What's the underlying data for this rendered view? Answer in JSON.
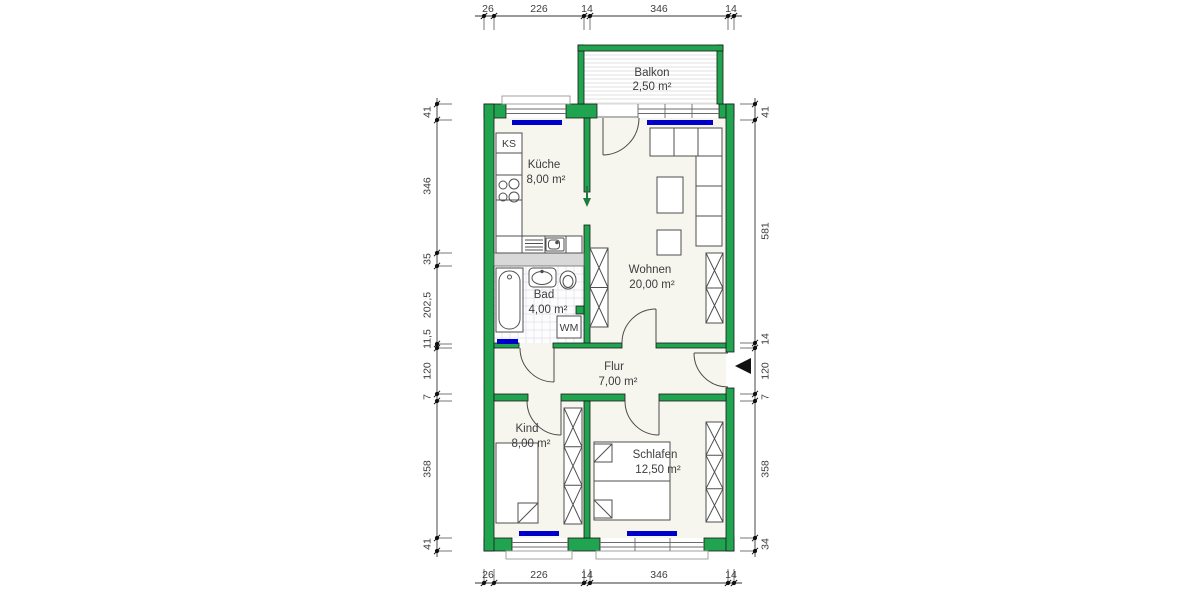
{
  "type": "floor-plan",
  "rooms": [
    {
      "name": "Balkon",
      "area": "2,50 m²"
    },
    {
      "name": "Küche",
      "area": "8,00 m²"
    },
    {
      "name": "Wohnen",
      "area": "20,00 m²"
    },
    {
      "name": "Bad",
      "area": "4,00 m²"
    },
    {
      "name": "Flur",
      "area": "7,00 m²"
    },
    {
      "name": "Kind",
      "area": "8,00 m²"
    },
    {
      "name": "Schlafen",
      "area": "12,50 m²"
    }
  ],
  "appliances": {
    "fridge": "KS",
    "washer": "WM"
  },
  "dimensions": {
    "top": [
      "26",
      "226",
      "14",
      "346",
      "14"
    ],
    "bottom": [
      "26",
      "226",
      "14",
      "346",
      "14"
    ],
    "left": [
      "41",
      "346",
      "35",
      "202,5",
      "11,5",
      "120",
      "7",
      "358",
      "41"
    ],
    "right": [
      "41",
      "581",
      "14",
      "120",
      "7",
      "358",
      "34"
    ]
  },
  "colors": {
    "wall": "#21a44f",
    "interior_wall_light": "#d8d8d8",
    "window_sill": "#0000cd",
    "floor": "#f6f5ee",
    "dimension": "#2b2b2b"
  }
}
